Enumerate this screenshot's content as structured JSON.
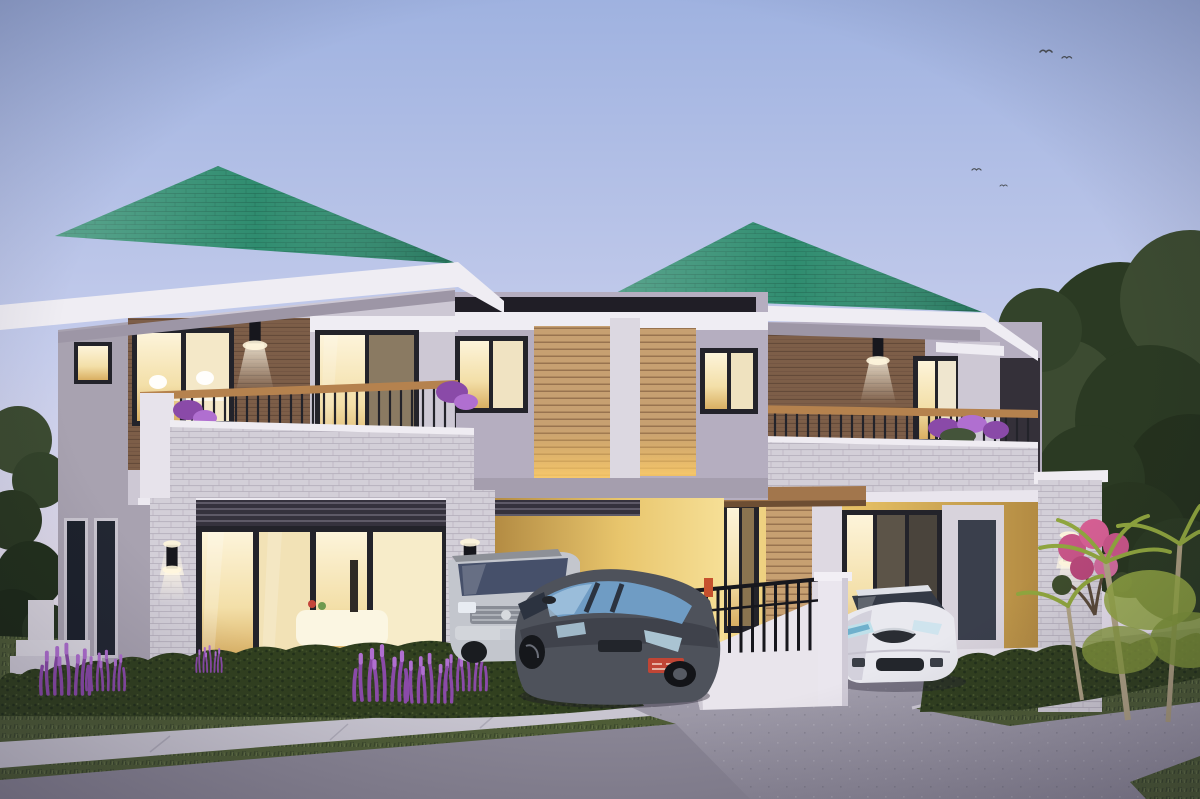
{
  "scene": {
    "description": "3D architectural rendering at dusk: twin two-storey modern duplex houses with teal-green hip roofs, stone-clad piers, wood siding, lit interiors, balconies, carports with three parked cars, hedges, lavender, palm and large trees, concrete driveway and sidewalk",
    "houses": 2,
    "vehicles": [
      "silver SUV",
      "dark gray hatchback",
      "white sedan"
    ],
    "birds": 4,
    "time_of_day": "dusk",
    "lighting": "warm interior and sconce lights on"
  },
  "palette": {
    "sky-top": "#9fb2e0",
    "sky-mid": "#c6cdec",
    "sky-horizon": "#e2dcea",
    "sky-low": "#efe6ec",
    "roof-green": "#2f8c6f",
    "roof-green-dark": "#226a54",
    "fascia-white": "#efedf3",
    "soffit-gray": "#9d96a6",
    "wall-light": "#cdc8d4",
    "wall-mid": "#b5aec0",
    "wall-dark": "#a8a2b0",
    "wood": "#7d5e48",
    "wood-dark": "#5f4636",
    "louver": "#c7a071",
    "louver-dark": "#8f6b49",
    "frame-dark": "#23232a",
    "glass-warm-1": "#fdf4da",
    "glass-warm-2": "#d9af62",
    "glass-cool": "#46506a",
    "stone": "#d3cfd8",
    "stone-line": "#b0aab8",
    "rail-wood": "#b5824e",
    "beam-wood": "#a2764c",
    "carport-1": "#b28a42",
    "carport-2": "#f6df96",
    "grass": "#4e5c36",
    "grass-dark": "#38452a",
    "grass-light": "#68774a",
    "hedge": "#31401f",
    "hedge-dark": "#22301a",
    "tree-dark": "#2b3a23",
    "tree-mid": "#3c4b31",
    "palm-green": "#8fa53e",
    "lavender": "#8a4aa8",
    "lavender-light": "#b06fd0",
    "pink-flower": "#c75588",
    "drive-light": "#aaa6b4",
    "drive-dark": "#8e8a99",
    "road": "#8a8695",
    "sidewalk": "#c8c5d0",
    "car-silver": "#c3c6cd",
    "car-dark": "#4e525b",
    "car-white": "#e9e9ef",
    "plate-red": "#c04535",
    "fence-black": "#17171d",
    "post-white": "#eae6ee",
    "bird-gray": "#4a4f55"
  }
}
